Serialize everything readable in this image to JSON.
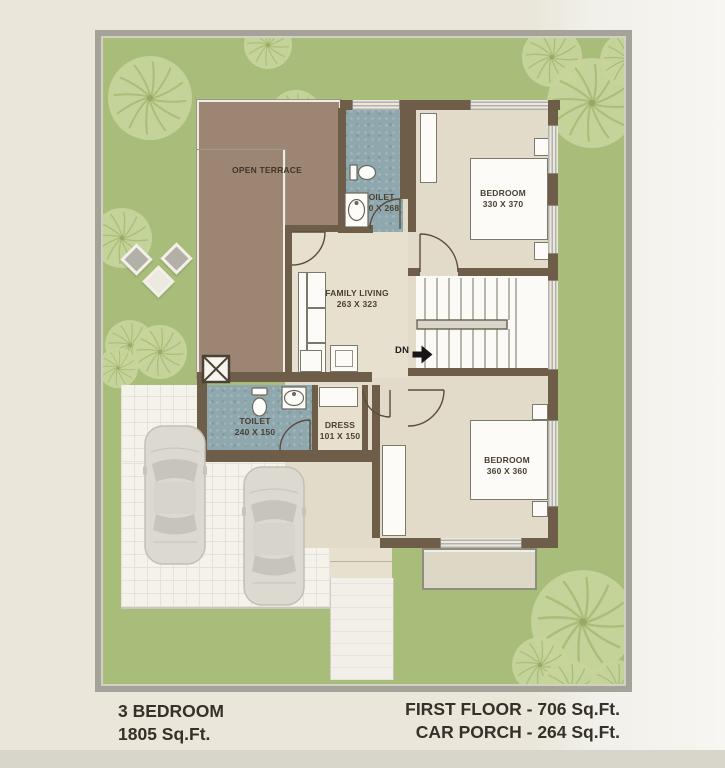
{
  "footer": {
    "left_line1": "3 BEDROOM",
    "left_line2": "1805 Sq.Ft.",
    "right_line1": "FIRST FLOOR - 706 Sq.Ft.",
    "right_line2": "CAR PORCH - 264 Sq.Ft."
  },
  "rooms": {
    "open_terrace": {
      "label": "OPEN TERRACE"
    },
    "toilet_top": {
      "label": "TOILET",
      "dims": "150 X 268"
    },
    "bedroom_top": {
      "label": "BEDROOM",
      "dims": "330 X 370"
    },
    "family_living": {
      "label": "FAMILY LIVING",
      "dims": "263 X 323"
    },
    "stairs": {
      "down_label": "DN"
    },
    "toilet_bottom": {
      "label": "TOILET",
      "dims": "240 X 150"
    },
    "dress": {
      "label": "DRESS",
      "dims": "101 X 150"
    },
    "bedroom_bottom": {
      "label": "BEDROOM",
      "dims": "360 X 360"
    }
  },
  "colors": {
    "lawn": "#a9bd7a",
    "terrace_brown": "#9c8673",
    "wall_brown": "#6e5d49",
    "toilet_tile": "#8fa8ae",
    "floor_beige": "#e2dbc9",
    "caption_text": "#35312a"
  }
}
